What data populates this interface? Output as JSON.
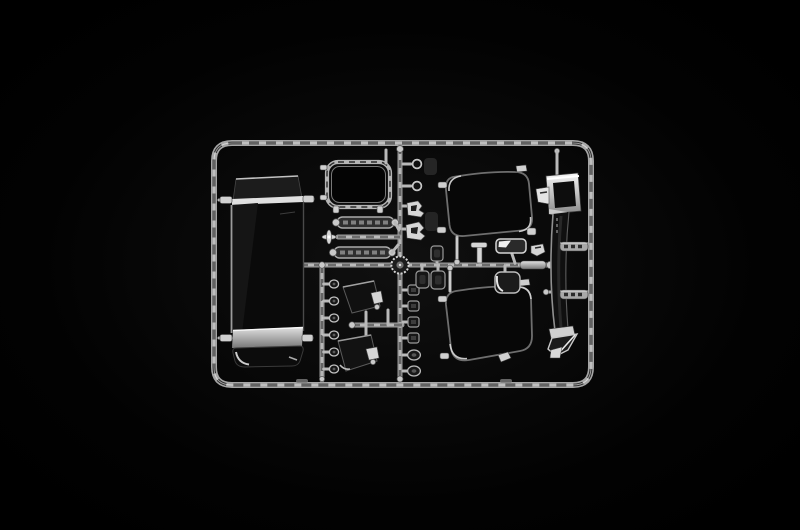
{
  "scene": {
    "type": "product-photo",
    "description": "Macro photo of a clear transparent plastic injection-moulded model kit sprue (runner) holding windshield, windows, mirrors and lens parts, lit against a black background",
    "background_color": "#000000",
    "visible_text": []
  },
  "palette": {
    "background": "#000000",
    "runner_light": "#9b9b9b",
    "runner_texture_dark": "#232323",
    "specular_highlight": "#f2f2f2",
    "glass_dark": "#070707",
    "chrome_bright": "#e8e8e8",
    "band_grey": "#c9c9c9"
  },
  "sprue": {
    "label": "Clear parts sprue",
    "frame": {
      "label": "Rounded rectangular runner frame"
    },
    "hub": {
      "label": "Central circular runner hub"
    },
    "runners": {
      "vertical_main": "Main vertical runner",
      "horizontal_main": "Main horizontal runner",
      "vertical_left": "Lower-left runner with lens parts",
      "connector_bars": "Connector runner between strip parts",
      "mirror_bar": "Mirror assembly runner"
    },
    "parts": {
      "windshield": {
        "label": "Large one-piece windscreen glass with bright reflection bands"
      },
      "hatch_frame": {
        "label": "Rounded roof-hatch window frame"
      },
      "strip_upper": {
        "label": "Elongated clear strip part, upper"
      },
      "strip_lower": {
        "label": "Elongated clear strip part, lower"
      },
      "star_clip": {
        "label": "Small cross shaped clip part"
      },
      "window_upper": {
        "label": "Rounded-square door window glass, upper right"
      },
      "window_lower": {
        "label": "Rounded-square door window glass, lower right"
      },
      "deflector": {
        "label": "Tall curved side deflector with chromed top and angled foot"
      },
      "mirror_upper": {
        "label": "Dark mirror glass, upper"
      },
      "mirror_lower": {
        "label": "Dark mirror glass, lower"
      },
      "lens_column_left": {
        "label": "Column of six small round lenses",
        "count": 6
      },
      "lamp_column_right": {
        "label": "Column of six small lamp lenses",
        "count": 6
      },
      "ring_lens_1": {
        "label": "Small ring lens"
      },
      "ring_lens_2": {
        "label": "Small ring lens"
      },
      "bracket_1": {
        "label": "Small bright bracket part"
      },
      "bracket_2": {
        "label": "Small bright bracket part"
      },
      "lamp_bar": {
        "label": "Rectangular lamp lens with bright facet"
      },
      "mirror_small": {
        "label": "Small rimmed mirror glass"
      },
      "t_arm": {
        "label": "Small T-shaped arm part"
      },
      "bright_bar": {
        "label": "Short bright bar part"
      },
      "box_parts": {
        "label": "Three small rounded box parts",
        "count": 3
      }
    }
  }
}
